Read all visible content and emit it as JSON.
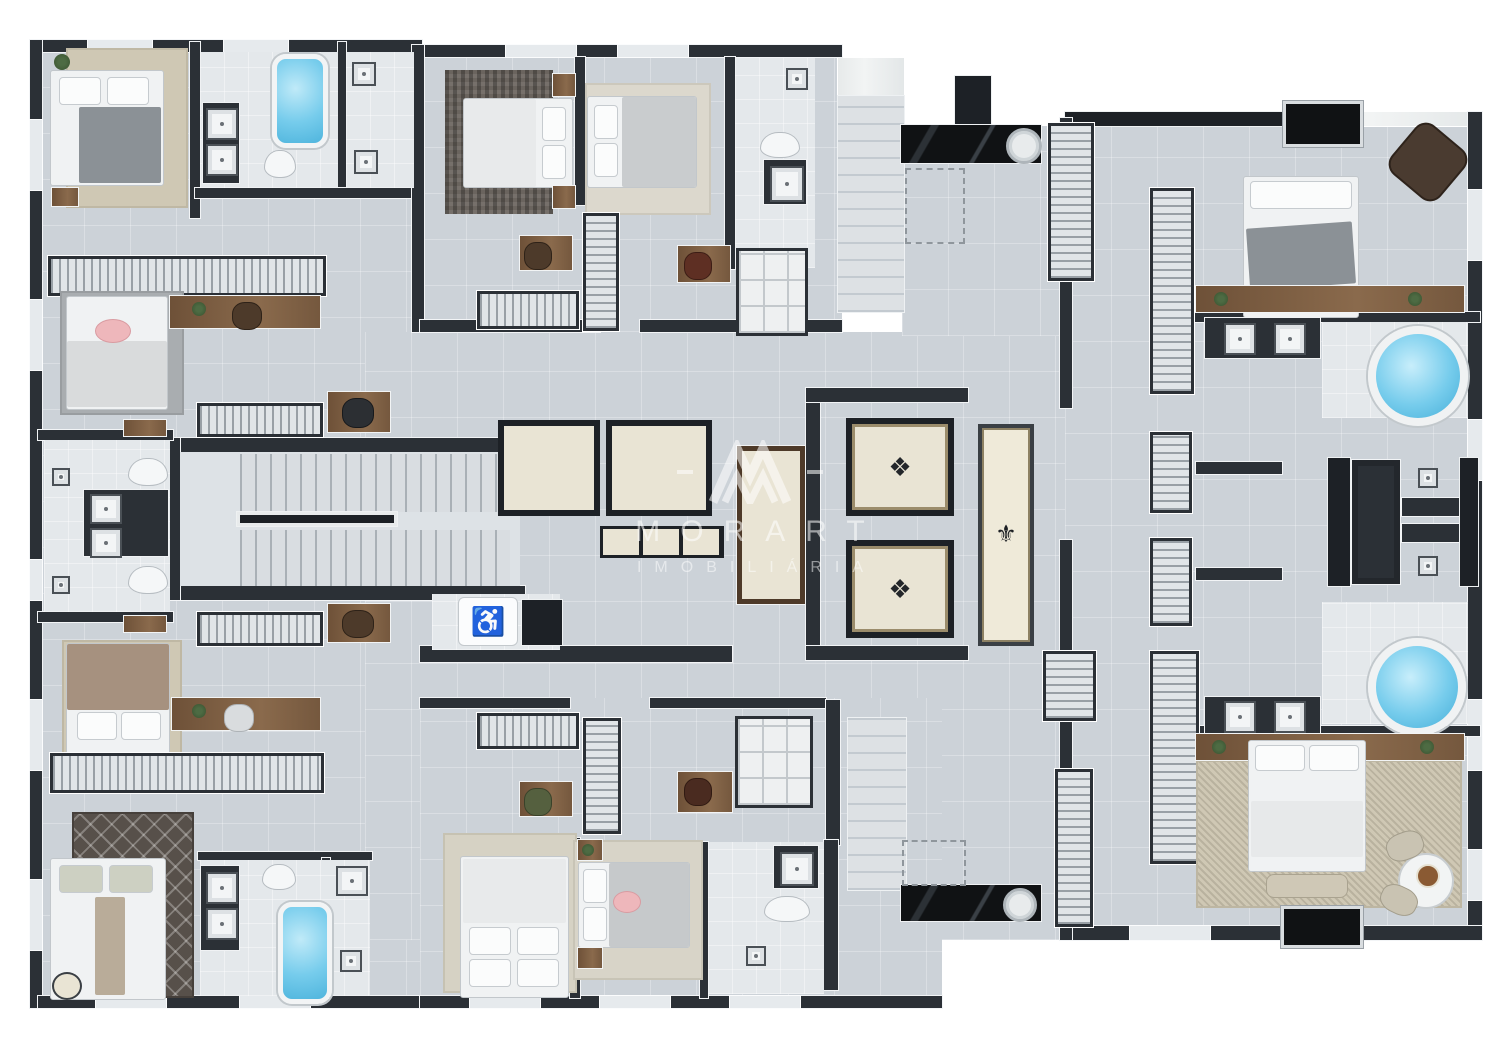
{
  "watermark": {
    "brand": "MORART",
    "subtitle": "IMOBILIÁRIA"
  },
  "icons": {
    "elevator_medallion": "❖",
    "hall_rug_fleur": "⚜",
    "accessible_wc": "♿"
  },
  "theme": {
    "background": "#ffffff",
    "wall": "#2b3036",
    "wall_dark": "#1d2126",
    "floor": "#ccd2d8",
    "floor_light": "#dde2e6",
    "bath_floor": "#e4e8eb",
    "marble": "#e9eceb",
    "wood": "#7d5f45",
    "wood_dark": "#4e3a29",
    "water": "#76ccec",
    "rug_beige": "#cfc8b4",
    "rug_gray": "#a9adb0",
    "rug_dark": "#57504a",
    "bed_white": "#f0f2f3",
    "blanket_gray": "#8b9196",
    "blanket_tan": "#a6917f",
    "elevator_floor": "#e9e4d4",
    "black_marble": "#17191c"
  },
  "fixtures_observed": {
    "bedrooms": 10,
    "bathrooms": 8,
    "elevator_cabs": 5,
    "staircases": 2,
    "round_hot_tubs": 2,
    "bathtubs": 2,
    "kitchen_counters": 2,
    "accessible_wc": 1,
    "wardrobe_racks": 14
  }
}
